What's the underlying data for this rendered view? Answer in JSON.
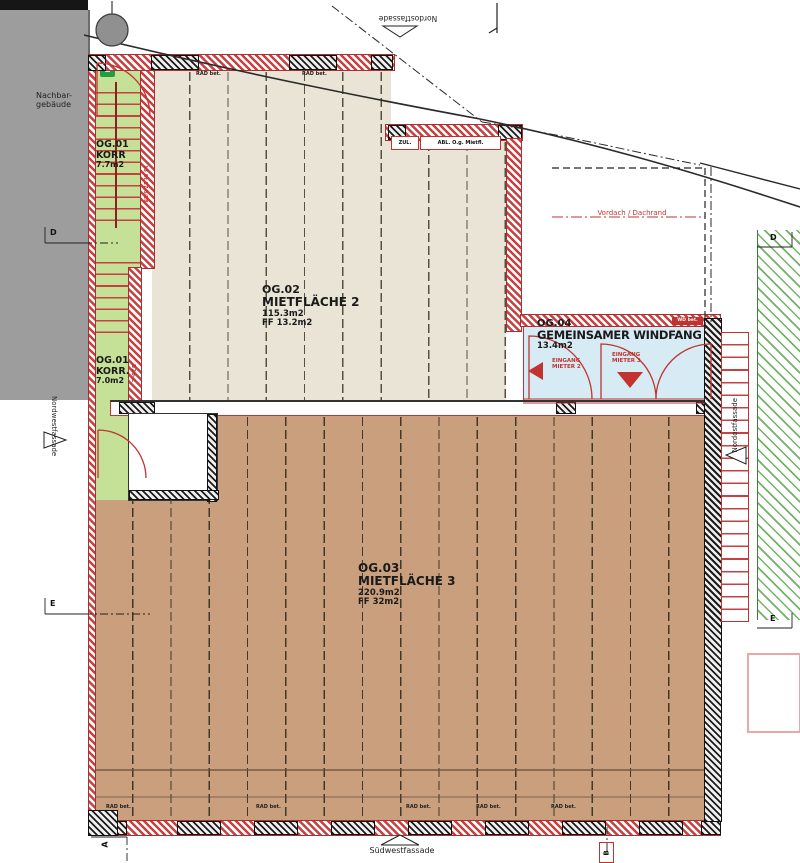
{
  "plan": {
    "rooms": {
      "korr_top": {
        "code": "OG.01",
        "name": "KORR",
        "area": "7.7m2"
      },
      "korr_bottom": {
        "code": "OG.01",
        "name": "KORR.",
        "area": "7.0m2"
      },
      "miet2": {
        "code": "OG.02",
        "name": "MIETFLÄCHE 2",
        "area": "115.3m2",
        "ff": "FF 13.2m2"
      },
      "miet3": {
        "code": "OG.03",
        "name": "MIETFLÄCHE 3",
        "area": "220.9m2",
        "ff": "FF 32m2"
      },
      "windfang": {
        "code": "OG.04",
        "name": "GEMEINSAMER WINDFANG",
        "area": "13.4m2"
      }
    },
    "labels": {
      "neighbor": "Nachbar-\ngebäude",
      "facade_nw": "Nordwestfassade",
      "facade_ne_top": "Nordostfassade",
      "facade_ne_right": "Nordostfassade",
      "facade_sw": "Südwestfassade",
      "vordach": "Vordach / Dachrand",
      "entrance_m2": "EINGANG\nMIETER 2",
      "entrance_m3": "EINGANG\nMIETER 3",
      "zul": "ZUL.",
      "abl": "ABL. O.g. Mietfl.",
      "rad": "RAD bet.",
      "stair_note": "13 St 17,5/28",
      "door_note": "B20-C",
      "badge": "WD bet."
    },
    "grid": {
      "d": "D",
      "e": "E",
      "a": "A",
      "b": "B"
    },
    "colors": {
      "red": "#c23330",
      "floor2": "#e9e4d6",
      "floor3": "#c99f7d",
      "corridor": "#c5e197",
      "windfang": "#d6ebf4",
      "neighbor": "#9d9d9d",
      "hatch_green": "#68af5c"
    }
  }
}
